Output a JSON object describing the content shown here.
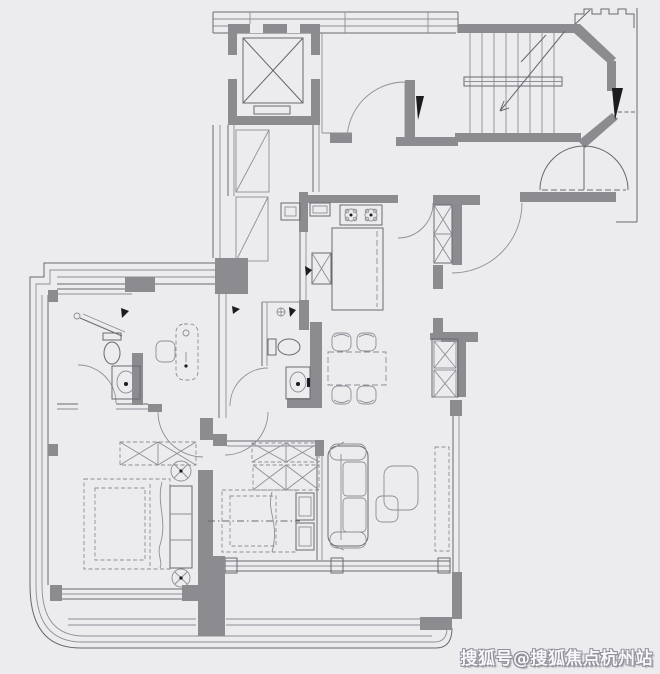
{
  "watermark": {
    "text": "搜狐号@搜狐焦点杭州站"
  },
  "colors": {
    "background": "#ecebee",
    "wall": "#8b8b90",
    "line": "#686870",
    "furn": "#8e8e96",
    "accent-black": "#1b1b20",
    "wm-fill": "#f8f7f9",
    "wm-shadow": "#90909a"
  },
  "plan": {
    "type": "residential-floor-plan",
    "fixtures": [
      "elevator",
      "staircase",
      "entry-double-door",
      "corridor-cabinets",
      "kitchen-stove",
      "kitchen-island",
      "kitchen-sink",
      "kitchen-cabinet-column",
      "utility-shaft",
      "master-bathroom-shower",
      "master-bathroom-toilet",
      "master-bathroom-sink",
      "guest-bathroom-shower",
      "guest-bathroom-toilet",
      "guest-bathroom-sink",
      "dining-table",
      "dining-chairs",
      "sofa",
      "coffee-table",
      "tv-cabinet",
      "master-bed",
      "nightstand-lamps",
      "second-bed",
      "wardrobes",
      "desk",
      "desk-chair",
      "balcony-railing",
      "bay-windows",
      "door-swings"
    ]
  }
}
